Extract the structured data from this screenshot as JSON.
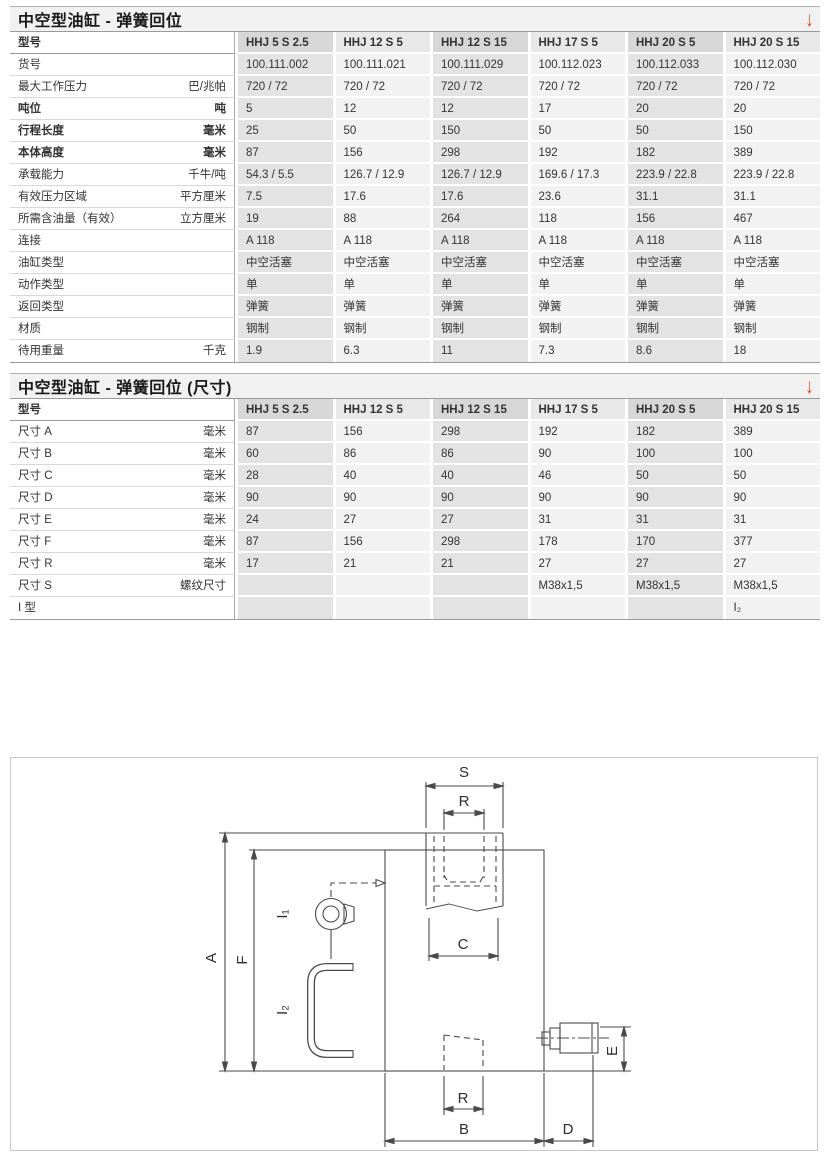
{
  "accent_color": "#e8491d",
  "sections": [
    {
      "title": "中空型油缸 - 弹簧回位",
      "arrow_icon": "↓",
      "header_label": "型号",
      "columns": [
        "HHJ 5 S 2.5",
        "HHJ 12 S 5",
        "HHJ 12 S 15",
        "HHJ 17 S 5",
        "HHJ 20 S 5",
        "HHJ 20 S 15"
      ],
      "rows": [
        {
          "label": "货号",
          "unit": "",
          "bold": false,
          "values": [
            "100.111.002",
            "100.111.021",
            "100.111.029",
            "100.112.023",
            "100.112.033",
            "100.112.030"
          ]
        },
        {
          "label": "最大工作压力",
          "unit": "巴/兆帕",
          "bold": false,
          "values": [
            "720 / 72",
            "720 / 72",
            "720 / 72",
            "720 / 72",
            "720 / 72",
            "720 / 72"
          ]
        },
        {
          "label": "吨位",
          "unit": "吨",
          "bold": true,
          "values": [
            "5",
            "12",
            "12",
            "17",
            "20",
            "20"
          ]
        },
        {
          "label": "行程长度",
          "unit": "毫米",
          "bold": true,
          "values": [
            "25",
            "50",
            "150",
            "50",
            "50",
            "150"
          ]
        },
        {
          "label": "本体高度",
          "unit": "毫米",
          "bold": true,
          "values": [
            "87",
            "156",
            "298",
            "192",
            "182",
            "389"
          ]
        },
        {
          "label": "承载能力",
          "unit": "千牛/吨",
          "bold": false,
          "values": [
            "54.3 / 5.5",
            "126.7 / 12.9",
            "126.7 / 12.9",
            "169.6 / 17.3",
            "223.9 / 22.8",
            "223.9 / 22.8"
          ]
        },
        {
          "label": "有效压力区域",
          "unit": "平方厘米",
          "bold": false,
          "values": [
            "7.5",
            "17.6",
            "17.6",
            "23.6",
            "31.1",
            "31.1"
          ]
        },
        {
          "label": "所需含油量（有效）",
          "unit": "立方厘米",
          "bold": false,
          "values": [
            "19",
            "88",
            "264",
            "118",
            "156",
            "467"
          ]
        },
        {
          "label": "连接",
          "unit": "",
          "bold": false,
          "values": [
            "A 118",
            "A 118",
            "A 118",
            "A 118",
            "A 118",
            "A 118"
          ]
        },
        {
          "label": "油缸类型",
          "unit": "",
          "bold": false,
          "values": [
            "中空活塞",
            "中空活塞",
            "中空活塞",
            "中空活塞",
            "中空活塞",
            "中空活塞"
          ]
        },
        {
          "label": "动作类型",
          "unit": "",
          "bold": false,
          "values": [
            "单",
            "单",
            "单",
            "单",
            "单",
            "单"
          ]
        },
        {
          "label": "返回类型",
          "unit": "",
          "bold": false,
          "values": [
            "弹簧",
            "弹簧",
            "弹簧",
            "弹簧",
            "弹簧",
            "弹簧"
          ]
        },
        {
          "label": "材质",
          "unit": "",
          "bold": false,
          "values": [
            "钢制",
            "钢制",
            "钢制",
            "钢制",
            "钢制",
            "钢制"
          ]
        },
        {
          "label": "待用重量",
          "unit": "千克",
          "bold": false,
          "values": [
            "1.9",
            "6.3",
            "11",
            "7.3",
            "8.6",
            "18"
          ]
        }
      ]
    },
    {
      "title": "中空型油缸 - 弹簧回位 (尺寸)",
      "arrow_icon": "↓",
      "header_label": "型号",
      "columns": [
        "HHJ 5 S 2.5",
        "HHJ 12 S 5",
        "HHJ 12 S 15",
        "HHJ 17 S 5",
        "HHJ 20 S 5",
        "HHJ 20 S 15"
      ],
      "rows": [
        {
          "label": "尺寸 A",
          "unit": "毫米",
          "bold": false,
          "values": [
            "87",
            "156",
            "298",
            "192",
            "182",
            "389"
          ]
        },
        {
          "label": "尺寸 B",
          "unit": "毫米",
          "bold": false,
          "values": [
            "60",
            "86",
            "86",
            "90",
            "100",
            "100"
          ]
        },
        {
          "label": "尺寸 C",
          "unit": "毫米",
          "bold": false,
          "values": [
            "28",
            "40",
            "40",
            "46",
            "50",
            "50"
          ]
        },
        {
          "label": "尺寸 D",
          "unit": "毫米",
          "bold": false,
          "values": [
            "90",
            "90",
            "90",
            "90",
            "90",
            "90"
          ]
        },
        {
          "label": "尺寸 E",
          "unit": "毫米",
          "bold": false,
          "values": [
            "24",
            "27",
            "27",
            "31",
            "31",
            "31"
          ]
        },
        {
          "label": "尺寸 F",
          "unit": "毫米",
          "bold": false,
          "values": [
            "87",
            "156",
            "298",
            "178",
            "170",
            "377"
          ]
        },
        {
          "label": "尺寸 R",
          "unit": "毫米",
          "bold": false,
          "values": [
            "17",
            "21",
            "21",
            "27",
            "27",
            "27"
          ]
        },
        {
          "label": "尺寸 S",
          "unit": "螺纹尺寸",
          "bold": false,
          "values": [
            "",
            "",
            "",
            "M38x1,5",
            "M38x1,5",
            "M38x1,5"
          ]
        },
        {
          "label": "I 型",
          "unit": "",
          "bold": false,
          "values": [
            "",
            "",
            "",
            "",
            "",
            "I₂"
          ]
        }
      ]
    }
  ],
  "diagram": {
    "labels": {
      "s": "S",
      "r_top": "R",
      "c": "C",
      "a": "A",
      "f": "F",
      "i1": "I₁",
      "i2": "I₂",
      "e": "E",
      "r_bottom": "R",
      "b": "B",
      "d": "D"
    }
  }
}
